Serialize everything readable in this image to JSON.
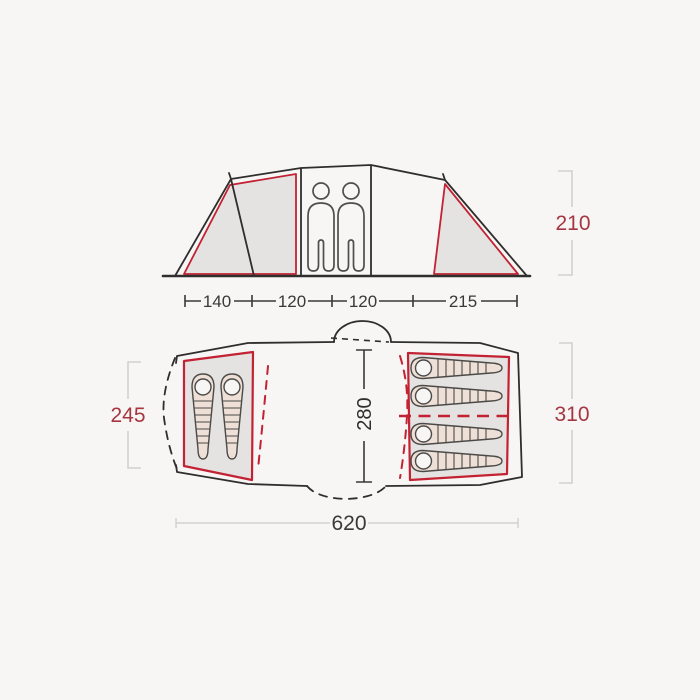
{
  "diagram": {
    "subject": "tent-dimensions-diagram",
    "description": "Top: side elevation of a tunnel tent with two occupants; bottom: floor plan with two sleeping cabins (2 + 4 sleeping bags)",
    "colors": {
      "background": "#f7f6f4",
      "outline_dark": "#2f2e2c",
      "accent_red": "#c22233",
      "label_red": "#a53642",
      "room_fill_gray": "#e4e3e1",
      "sleeping_bag_fill": "#eee0d6",
      "dim_line_light": "#d2d0cd",
      "dim_text_dark": "#3a3938"
    },
    "side_view": {
      "height_label": "210",
      "width_segments": [
        "140",
        "120",
        "120",
        "215"
      ],
      "person_count": 2
    },
    "floor_plan": {
      "left_cabin_depth_label": "245",
      "inner_width_label": "280",
      "right_cabin_depth_label": "310",
      "total_length_label": "620",
      "left_cabin_sleeping_bags": 2,
      "right_cabin_sleeping_bags": 4
    }
  }
}
